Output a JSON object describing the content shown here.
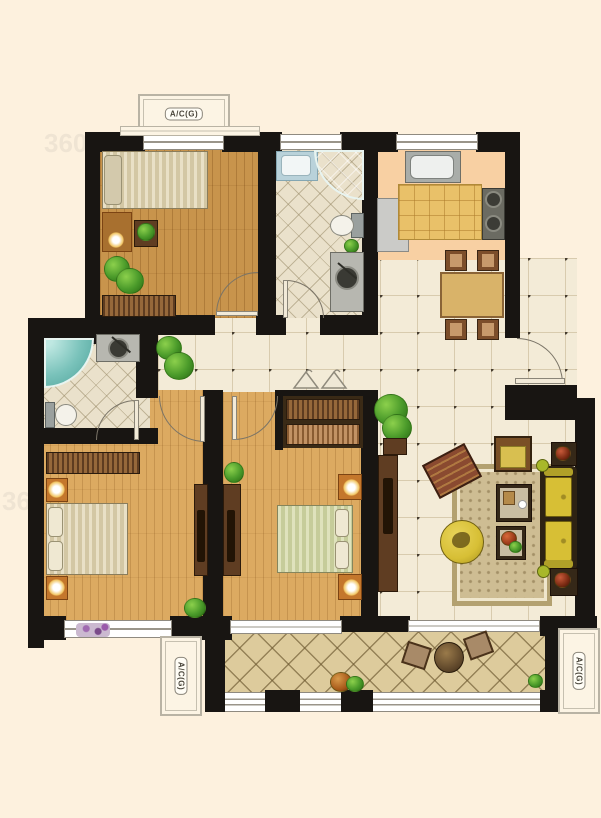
{
  "labels": {
    "ac_unit": "A/C(G)"
  },
  "watermark": "360",
  "colors": {
    "wall": "#181512",
    "background": "#fdf1de",
    "wood_warm": "#c8944c",
    "wood_light": "#dcaa61",
    "tile_floor": "#f3ebd7",
    "tile_line": "#d8cbae",
    "tile_dot": "#453c2e",
    "bath_floor": "#eae1cb",
    "kitchen_floor": "#f8d0a3",
    "counter": "#e9c169",
    "balcony_floor": "#ddcb9c",
    "shower": "#79c2ba",
    "sofa": "#d7bf35",
    "rug": "#cebd93",
    "furniture_dark": "#5f3d22",
    "plant": "#3f8f26",
    "window": "#ffffff"
  }
}
